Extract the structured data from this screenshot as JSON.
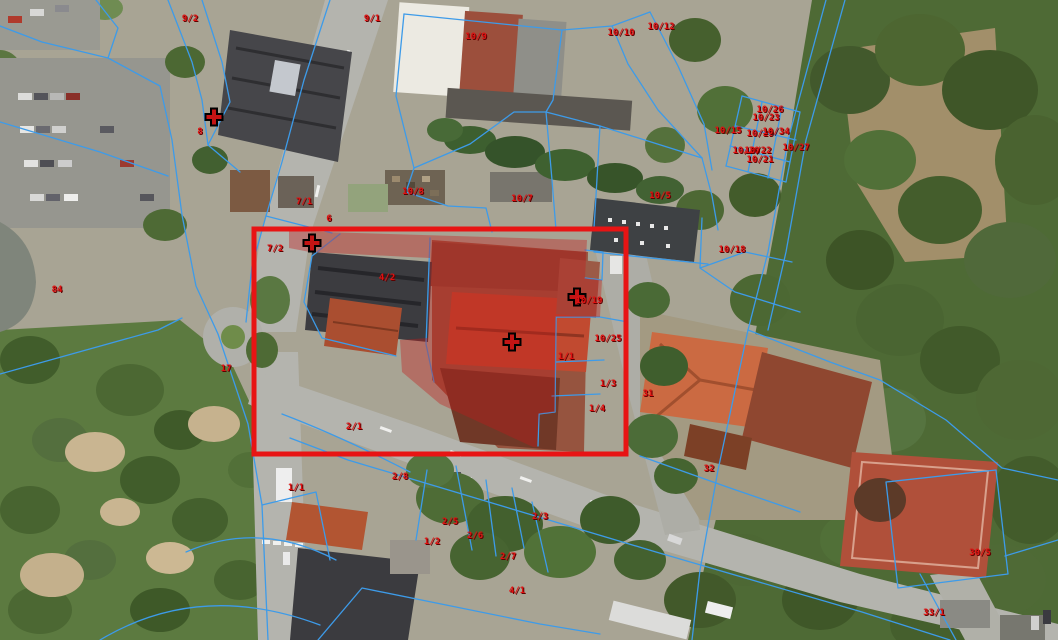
{
  "map": {
    "type": "cadastral-aerial-view",
    "colors": {
      "boundary": "#3d9be9",
      "label": "#e01111",
      "label_shadow": "#5e0000",
      "highlight": "#e81414",
      "marker": "#c41414",
      "marker_outline": "#000000",
      "tint": "rgba(195,25,25,0.38)"
    },
    "highlight_rect": {
      "x": 254,
      "y": 229,
      "width": 372,
      "height": 225
    },
    "highlight_polygon": "M289,231 L587,240 L585,278 L602,280 L600,317 L556,317 L555,412 L539,414 L537,447 L533,447 L440,404 L402,372 L400,340 L428,338 L430,258 L310,252 L289,248 Z",
    "crosses": [
      {
        "x": 214,
        "y": 117
      },
      {
        "x": 312,
        "y": 243
      },
      {
        "x": 512,
        "y": 342
      },
      {
        "x": 577,
        "y": 297
      }
    ],
    "parcel_labels": [
      {
        "text": "9/2",
        "x": 190,
        "y": 19
      },
      {
        "text": "9/1",
        "x": 372,
        "y": 19
      },
      {
        "text": "10/9",
        "x": 476,
        "y": 37
      },
      {
        "text": "10/10",
        "x": 621,
        "y": 33
      },
      {
        "text": "10/12",
        "x": 661,
        "y": 27
      },
      {
        "text": "8",
        "x": 200,
        "y": 132
      },
      {
        "text": "10/8",
        "x": 413,
        "y": 192
      },
      {
        "text": "10/7",
        "x": 522,
        "y": 199
      },
      {
        "text": "10/5",
        "x": 660,
        "y": 196
      },
      {
        "text": "10/15",
        "x": 728,
        "y": 131
      },
      {
        "text": "10/26",
        "x": 770,
        "y": 110
      },
      {
        "text": "10/23",
        "x": 766,
        "y": 118
      },
      {
        "text": "10/29",
        "x": 760,
        "y": 134
      },
      {
        "text": "10/34",
        "x": 776,
        "y": 132
      },
      {
        "text": "10/27",
        "x": 796,
        "y": 148
      },
      {
        "text": "10/20",
        "x": 746,
        "y": 151
      },
      {
        "text": "10/22",
        "x": 758,
        "y": 151
      },
      {
        "text": "10/21",
        "x": 760,
        "y": 160
      },
      {
        "text": "10/18",
        "x": 732,
        "y": 250
      },
      {
        "text": "7/1",
        "x": 304,
        "y": 202
      },
      {
        "text": "6",
        "x": 329,
        "y": 219
      },
      {
        "text": "7/2",
        "x": 275,
        "y": 249
      },
      {
        "text": "4/2",
        "x": 387,
        "y": 278
      },
      {
        "text": "10/19",
        "x": 589,
        "y": 301
      },
      {
        "text": "10/25",
        "x": 608,
        "y": 339
      },
      {
        "text": "1/1",
        "x": 566,
        "y": 357
      },
      {
        "text": "1/3",
        "x": 608,
        "y": 384
      },
      {
        "text": "1/4",
        "x": 597,
        "y": 409
      },
      {
        "text": "31",
        "x": 648,
        "y": 394
      },
      {
        "text": "32",
        "x": 709,
        "y": 469
      },
      {
        "text": "30/5",
        "x": 980,
        "y": 553
      },
      {
        "text": "33/1",
        "x": 934,
        "y": 613
      },
      {
        "text": "2/1",
        "x": 354,
        "y": 427
      },
      {
        "text": "17",
        "x": 226,
        "y": 369
      },
      {
        "text": "84",
        "x": 57,
        "y": 290
      },
      {
        "text": "1/1",
        "x": 296,
        "y": 488
      },
      {
        "text": "2/8",
        "x": 400,
        "y": 477
      },
      {
        "text": "2/5",
        "x": 450,
        "y": 522
      },
      {
        "text": "2/6",
        "x": 475,
        "y": 536
      },
      {
        "text": "1/2",
        "x": 432,
        "y": 542
      },
      {
        "text": "2/3",
        "x": 540,
        "y": 517
      },
      {
        "text": "2/7",
        "x": 508,
        "y": 557
      },
      {
        "text": "4/1",
        "x": 517,
        "y": 591
      }
    ]
  }
}
